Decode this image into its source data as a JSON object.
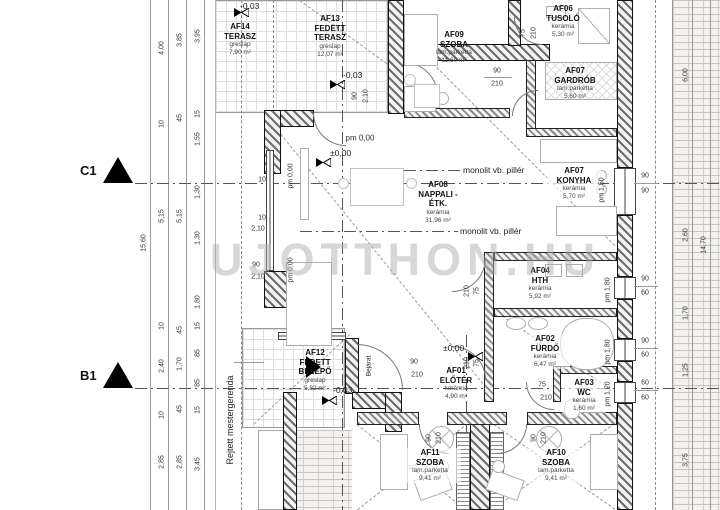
{
  "watermark": "UJOTTHON.HU",
  "sections": {
    "c1": "C1",
    "b1": "B1"
  },
  "rooms": [
    {
      "id": "AF14",
      "name": "TERASZ",
      "finish": "greslap",
      "area": "7,90 m²"
    },
    {
      "id": "AF13",
      "name": "FEDETT TERASZ",
      "finish": "greslap",
      "area": "12,07 m²"
    },
    {
      "id": "AF09",
      "name": "SZOBA",
      "finish": "lam.parketta",
      "area": "11,60 m²"
    },
    {
      "id": "AF06",
      "name": "TUSOLÓ",
      "finish": "kerámia",
      "area": "5,30 m²"
    },
    {
      "id": "AF07",
      "name": "GARDRÓB",
      "finish": "lam.parketta",
      "area": "5,60 m²"
    },
    {
      "id": "AF07",
      "name": "KONYHA",
      "finish": "kerámia",
      "area": "5,70 m²"
    },
    {
      "id": "AF08",
      "name": "NAPPALI - ÉTK.",
      "finish": "kerámia",
      "area": "31,96 m²"
    },
    {
      "id": "AF04",
      "name": "HTH",
      "finish": "kerámia",
      "area": "5,92 m²"
    },
    {
      "id": "AF02",
      "name": "FÜRDŐ",
      "finish": "kerámia",
      "area": "6,47 m²"
    },
    {
      "id": "AF12",
      "name": "FEDETT BELÉPŐ",
      "finish": "greslap",
      "area": "5,82 m²"
    },
    {
      "id": "AF01",
      "name": "ELŐTÉR",
      "finish": "kerámia",
      "area": "4,90 m²"
    },
    {
      "id": "AF03",
      "name": "WC",
      "finish": "kerámia",
      "area": "1,60 m²"
    },
    {
      "id": "AF11",
      "name": "SZOBA",
      "finish": "lam.parketta",
      "area": "9,41 m²"
    },
    {
      "id": "AF10",
      "name": "SZOBA",
      "finish": "lam.parketta",
      "area": "9,41 m²"
    }
  ],
  "ann": {
    "pillar_top": "monolit vb. pillér",
    "pillar_mid": "monolit vb. pillér",
    "hidden_beam": "Rejtett mestergerenda",
    "entrance": "Bejárat"
  },
  "elev": {
    "t1": "-0,03",
    "t2": "-0,03",
    "t3": "-0,03",
    "z1": "±0,00",
    "z2": "±0,00",
    "pm0a": "pm 0,00",
    "pm0b": "pm 0,00",
    "pm0c": "pm 0,00"
  },
  "par": {
    "kitchen": "pm 1,50",
    "hth": "pm 1,80",
    "furdo": "pm 1,80",
    "wc": "pm 1,20"
  },
  "dd": {
    "af13": {
      "w": "90",
      "h": "2,10"
    },
    "corridor": {
      "w": "90",
      "h": "210"
    },
    "tusolo": {
      "w": "75",
      "h": "210"
    },
    "hth": {
      "w": "75",
      "h": "210"
    },
    "furdo": {
      "w": "75",
      "h": "210"
    },
    "wc": {
      "w": "75",
      "h": "210"
    },
    "entry": {
      "w": "90",
      "h": "210"
    },
    "szoba11": {
      "w": "90",
      "h": "210"
    },
    "szoba10": {
      "w": "90",
      "h": "210"
    },
    "west": {
      "a": "2,10",
      "b": "90",
      "c": "2,10"
    },
    "s10a": "10",
    "s10b": "10"
  },
  "win": {
    "k": [
      "90",
      "90"
    ],
    "hth": [
      "90",
      "60"
    ],
    "furdo": [
      "90",
      "60"
    ],
    "wc": [
      "60",
      "60"
    ]
  },
  "left": {
    "overall": "15,60",
    "a": [
      "4,00",
      "10",
      "5,15",
      "10",
      "2,40",
      "10",
      "2,85"
    ],
    "b": [
      "3,85",
      "45",
      "5,15",
      "45",
      "1,70",
      "45",
      "2,85"
    ],
    "c": [
      "3,95",
      "15",
      "1,55",
      "1,30",
      "1,30",
      "1,80",
      "15",
      "85",
      "85",
      "15",
      "3,45"
    ]
  },
  "right": {
    "overall": "14,70",
    "chain": [
      "6,00",
      "2,60",
      "1,70",
      "1,25",
      "3,75"
    ]
  }
}
